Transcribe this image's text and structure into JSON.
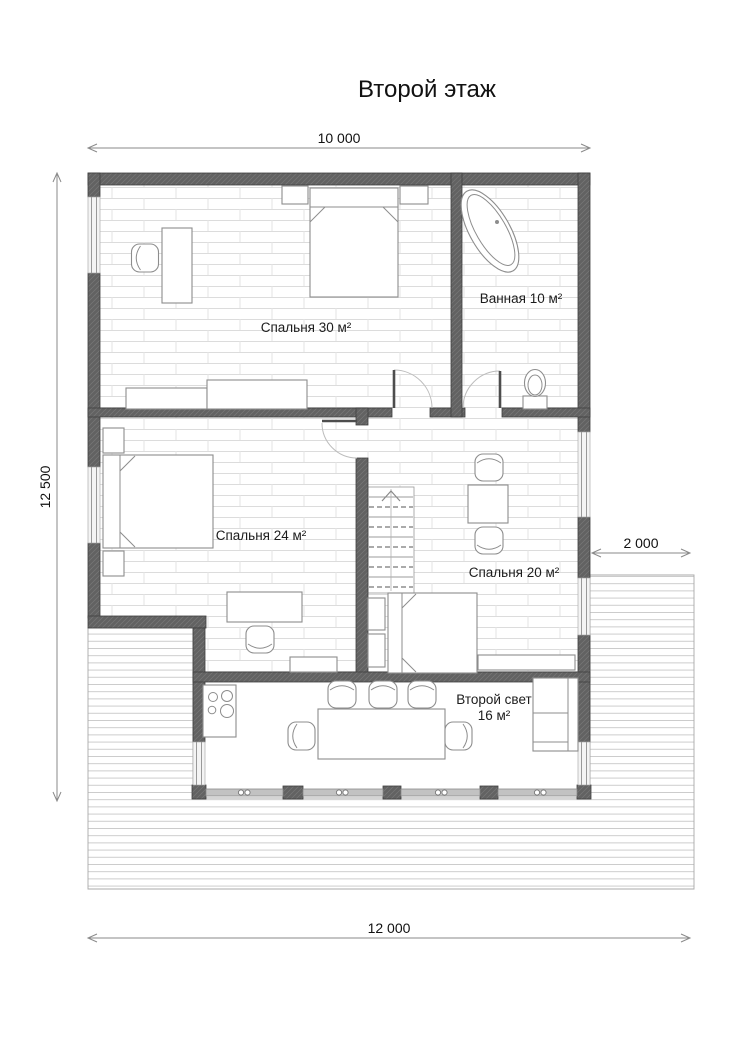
{
  "title": "Второй этаж",
  "floor_plan": {
    "rooms": [
      {
        "id": "bedroom-30",
        "label": "Спальня 30 м²"
      },
      {
        "id": "bathroom",
        "label": "Ванная 10 м²"
      },
      {
        "id": "bedroom-24",
        "label": "Спальня 24 м²"
      },
      {
        "id": "bedroom-20",
        "label": "Спальня 20 м²"
      },
      {
        "id": "second-light",
        "label": "Второй свет",
        "area_label": "16 м²"
      }
    ],
    "dimensions": {
      "top": "10 000",
      "left": "12 500",
      "right": "2 000",
      "bottom": "12 000"
    }
  }
}
